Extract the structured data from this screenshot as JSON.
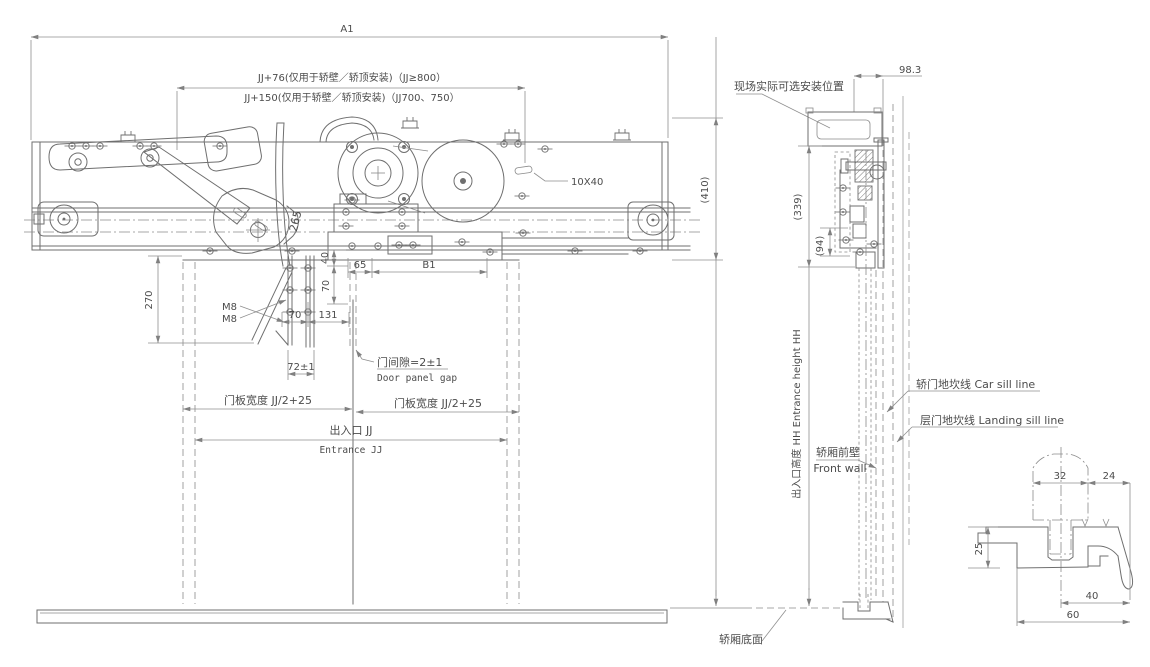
{
  "front_view": {
    "dim_a1": "A1",
    "dim_jj76": "JJ+76(仅用于轿壁／轿顶安装)（JJ≥800）",
    "dim_jj150": "JJ+150(仅用于轿壁／轿顶安装)（JJ700、750）",
    "label_10x40": "10X40",
    "dim_410": "(410)",
    "dim_265": "265",
    "dim_270": "270",
    "label_m8_1": "M8",
    "label_m8_2": "M8",
    "dim_40": "40",
    "dim_70_vertical": "70",
    "dim_65": "65",
    "dim_b1": "B1",
    "dim_70": "70",
    "dim_131": "131",
    "dim_72": "72±1",
    "door_gap_cn": "门间隙=2±1",
    "door_gap_en": "Door panel gap",
    "panel_width_left": "门板宽度 JJ/2+25",
    "panel_width_right": "门板宽度 JJ/2+25",
    "entrance_cn": "出入口 JJ",
    "entrance_en": "Entrance  JJ"
  },
  "side_view": {
    "mount_position": "现场实际可选安装位置",
    "dim_98_3": "98.3",
    "dim_339": "(339)",
    "dim_94": "(94)",
    "entrance_height": "出入口高度 HH Entrance height HH",
    "front_wall_cn": "轿厢前壁",
    "front_wall_en": "Front wall",
    "car_sill_line": "轿门地坎线 Car sill line",
    "landing_sill_line": "层门地坎线 Landing sill line",
    "car_bottom": "轿厢底面"
  },
  "sill_detail": {
    "dim_32": "32",
    "dim_24": "24",
    "dim_25": "25",
    "dim_40": "40",
    "dim_60": "60"
  },
  "colors": {
    "background": "#ffffff",
    "line": "#6f6f6f",
    "dim_line": "#8f8f8f",
    "text": "#4c4c4c"
  }
}
